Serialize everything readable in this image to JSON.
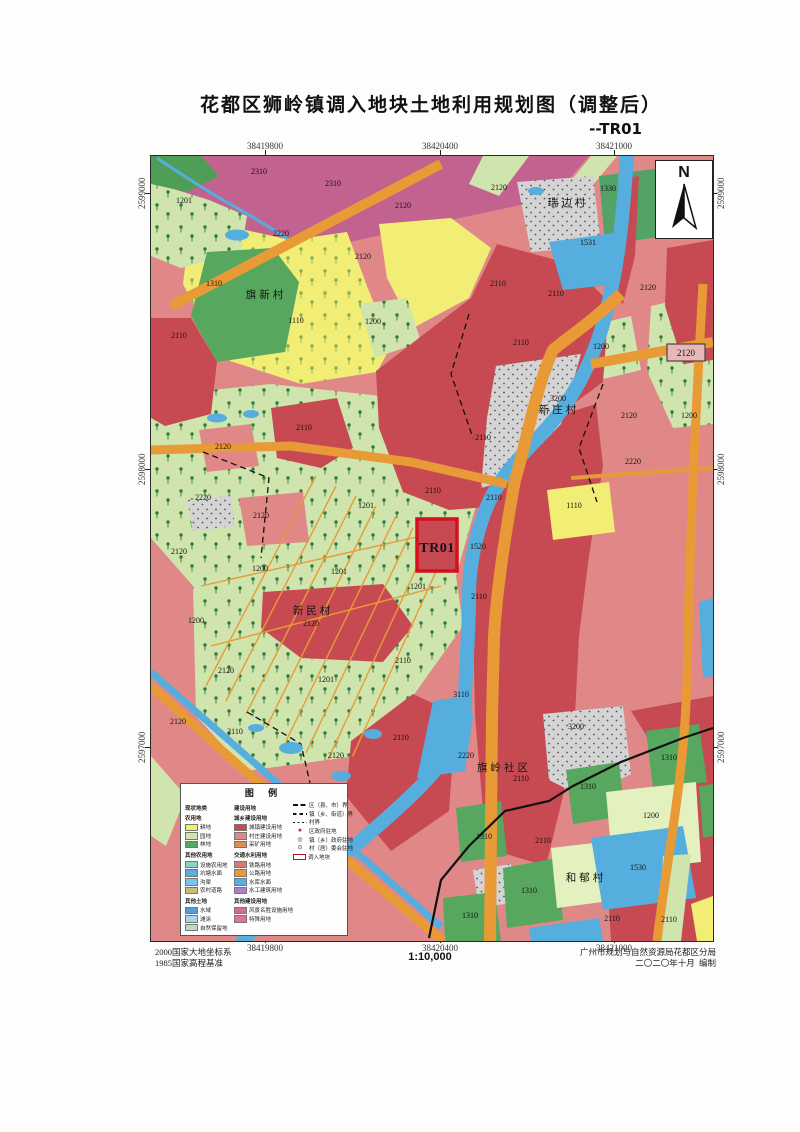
{
  "page": {
    "title": "花都区狮岭镇调入地块土地利用规划图（调整后）",
    "subtitle": "--TR01"
  },
  "north": {
    "label": "N"
  },
  "coordinates": {
    "top": [
      {
        "text": "38419800",
        "x": 115
      },
      {
        "text": "38420400",
        "x": 290
      },
      {
        "text": "38421000",
        "x": 464
      }
    ],
    "bottom": [
      {
        "text": "38419800",
        "x": 115
      },
      {
        "text": "38420400",
        "x": 290
      },
      {
        "text": "38421000",
        "x": 464
      }
    ],
    "left": [
      {
        "text": "2599000",
        "y": 38
      },
      {
        "text": "2598000",
        "y": 314
      },
      {
        "text": "2597000",
        "y": 592
      }
    ],
    "right": [
      {
        "text": "2599000",
        "y": 38
      },
      {
        "text": "2598000",
        "y": 314
      },
      {
        "text": "2597000",
        "y": 592
      }
    ]
  },
  "map": {
    "tr01_label": "TR01",
    "boxed_label": "2120",
    "villages": [
      [
        "瑞边村",
        417,
        50
      ],
      [
        "旗新村",
        115,
        142
      ],
      [
        "新庄村",
        408,
        257
      ],
      [
        "新民村",
        162,
        458
      ],
      [
        "旗岭社区",
        353,
        615
      ],
      [
        "和郁村",
        435,
        725
      ]
    ],
    "codes": [
      [
        "2310",
        108,
        18
      ],
      [
        "2310",
        182,
        30
      ],
      [
        "1201",
        33,
        47
      ],
      [
        "2120",
        252,
        52
      ],
      [
        "2120",
        348,
        34
      ],
      [
        "1330",
        457,
        35
      ],
      [
        "2220",
        130,
        80
      ],
      [
        "2120",
        212,
        103
      ],
      [
        "1531",
        437,
        89
      ],
      [
        "2110",
        347,
        130
      ],
      [
        "2110",
        405,
        140
      ],
      [
        "2120",
        497,
        134
      ],
      [
        "1310",
        63,
        130
      ],
      [
        "1110",
        145,
        167
      ],
      [
        "1200",
        222,
        168
      ],
      [
        "2110",
        28,
        182
      ],
      [
        "2110",
        370,
        189
      ],
      [
        "1200",
        450,
        193
      ],
      [
        "3200",
        407,
        245
      ],
      [
        "2120",
        478,
        262
      ],
      [
        "1200",
        538,
        262
      ],
      [
        "2110",
        332,
        284
      ],
      [
        "2110",
        153,
        274
      ],
      [
        "2120",
        72,
        293
      ],
      [
        "2220",
        482,
        308
      ],
      [
        "1110",
        423,
        352
      ],
      [
        "2110",
        343,
        344
      ],
      [
        "2110",
        282,
        337
      ],
      [
        "2220",
        52,
        344
      ],
      [
        "2120",
        110,
        362
      ],
      [
        "2120",
        28,
        398
      ],
      [
        "1201",
        215,
        352
      ],
      [
        "1520",
        327,
        393
      ],
      [
        "1200",
        109,
        415
      ],
      [
        "1201",
        188,
        418
      ],
      [
        "1201",
        267,
        433
      ],
      [
        "2120",
        160,
        470
      ],
      [
        "1200",
        45,
        467
      ],
      [
        "2110",
        328,
        443
      ],
      [
        "2110",
        252,
        507
      ],
      [
        "2120",
        75,
        517
      ],
      [
        "1201",
        175,
        526
      ],
      [
        "3110",
        310,
        541
      ],
      [
        "2110",
        250,
        584
      ],
      [
        "2120",
        27,
        568
      ],
      [
        "2110",
        84,
        578
      ],
      [
        "2120",
        185,
        602
      ],
      [
        "2220",
        315,
        602
      ],
      [
        "2110",
        370,
        625
      ],
      [
        "3200",
        425,
        573
      ],
      [
        "1310",
        518,
        604
      ],
      [
        "1310",
        437,
        633
      ],
      [
        "1200",
        500,
        662
      ],
      [
        "1310",
        333,
        683
      ],
      [
        "2110",
        392,
        687
      ],
      [
        "1530",
        487,
        714
      ],
      [
        "1310",
        378,
        737
      ],
      [
        "1310",
        319,
        762
      ],
      [
        "2110",
        461,
        765
      ],
      [
        "2110",
        518,
        766
      ]
    ]
  },
  "legend": {
    "title": "图 例",
    "col1": [
      {
        "k": "h",
        "t": "现状地类"
      },
      {
        "k": "h",
        "t": "农用地"
      },
      {
        "k": "c",
        "c": "#f2ed75",
        "t": "耕地"
      },
      {
        "k": "c",
        "c": "#cfe5ad",
        "t": "园地"
      },
      {
        "k": "c",
        "c": "#58a75e",
        "t": "林地"
      },
      {
        "k": "h",
        "t": "其他农用地"
      },
      {
        "k": "c",
        "c": "#8fd0c0",
        "t": "设施农用地"
      },
      {
        "k": "c",
        "c": "#58aee0",
        "t": "坑塘水面"
      },
      {
        "k": "c",
        "c": "#79c6e8",
        "t": "沟渠"
      },
      {
        "k": "c",
        "c": "#cbb97c",
        "t": "农村道路"
      },
      {
        "k": "h",
        "t": "其他土地"
      },
      {
        "k": "c",
        "c": "#4f9fd8",
        "t": "水域"
      },
      {
        "k": "c",
        "c": "#a5d6ec",
        "t": "滩涂"
      },
      {
        "k": "c",
        "c": "#c2d8c4",
        "t": "自然保留地"
      }
    ],
    "col2": [
      {
        "k": "h",
        "t": "建设用地"
      },
      {
        "k": "h",
        "t": "城乡建设用地"
      },
      {
        "k": "c",
        "c": "#c74a52",
        "t": "城镇建设用地"
      },
      {
        "k": "c",
        "c": "#e08888",
        "t": "村庄建设用地"
      },
      {
        "k": "c",
        "c": "#d9904e",
        "t": "采矿用地"
      },
      {
        "k": "h",
        "t": "交通水利用地"
      },
      {
        "k": "c",
        "c": "#d97b6c",
        "t": "铁路用地"
      },
      {
        "k": "c",
        "c": "#e89a36",
        "t": "公路用地"
      },
      {
        "k": "c",
        "c": "#58aee0",
        "t": "水库水面"
      },
      {
        "k": "c",
        "c": "#b07fc7",
        "t": "水工建筑用地"
      },
      {
        "k": "h",
        "t": "其他建设用地"
      },
      {
        "k": "c",
        "c": "#d46a9e",
        "t": "风景名胜设施用地"
      },
      {
        "k": "c",
        "c": "#e0729a",
        "t": "特殊用地"
      }
    ],
    "col3": [
      {
        "k": "l",
        "v": "a",
        "t": "区（县、市）界"
      },
      {
        "k": "l",
        "v": "b",
        "t": "镇（乡、街道）界"
      },
      {
        "k": "l",
        "v": "c",
        "t": "村界"
      },
      {
        "k": "s",
        "g": "★",
        "c": "#c01425",
        "t": "区政府驻地"
      },
      {
        "k": "s",
        "g": "◎",
        "c": "#333333",
        "t": "镇（乡）政府驻地"
      },
      {
        "k": "s",
        "g": "⊙",
        "c": "#333333",
        "t": "村（居）委会驻地"
      },
      {
        "k": "r",
        "t": "调入地块"
      }
    ]
  },
  "footer": {
    "datum1": "2000国家大地坐标系",
    "datum2": "1985国家高程基准",
    "scale": "1:10,000",
    "agency": "广州市规划与自然资源局花都区分局",
    "date": "二〇二〇年十月",
    "credit": "编制"
  }
}
